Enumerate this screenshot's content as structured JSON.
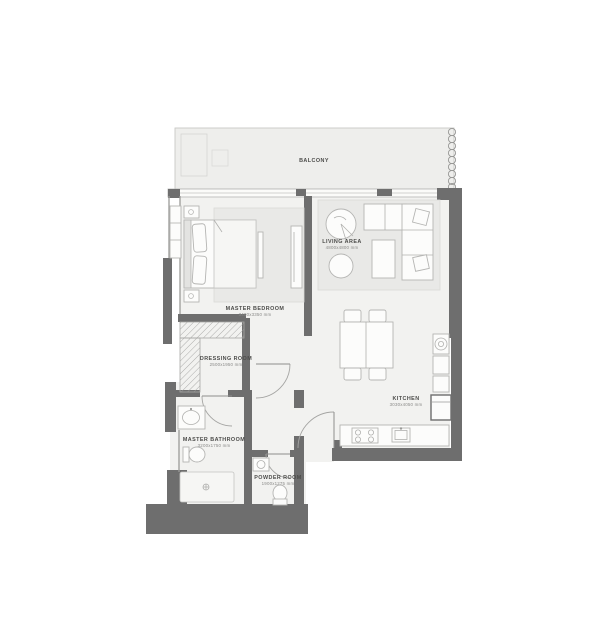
{
  "plan_title": "apartment-floor-plan",
  "rooms": {
    "balcony": {
      "label": "BALCONY"
    },
    "living_area": {
      "label": "LIVING AREA",
      "dimensions": "4800x4800 mm"
    },
    "master_bedroom": {
      "label": "MASTER BEDROOM",
      "dimensions": "3400x3350 mm"
    },
    "dressing_room": {
      "label": "DRESSING ROOM",
      "dimensions": "2500x1950 mm"
    },
    "master_bathroom": {
      "label": "MASTER BATHROOM",
      "dimensions": "3200x1750 mm"
    },
    "powder_room": {
      "label": "POWDER ROOM",
      "dimensions": "1900x1275 mm"
    },
    "kitchen": {
      "label": "KITCHEN",
      "dimensions": "3030x4050 mm"
    }
  },
  "colors": {
    "wall": "#6e6e6e",
    "floor": "#f2f2f0",
    "rug": "#e9e9e7",
    "balcony_floor": "#eeeeec",
    "label_text": "#4c4c4a",
    "dims_text": "#8a8a88"
  }
}
